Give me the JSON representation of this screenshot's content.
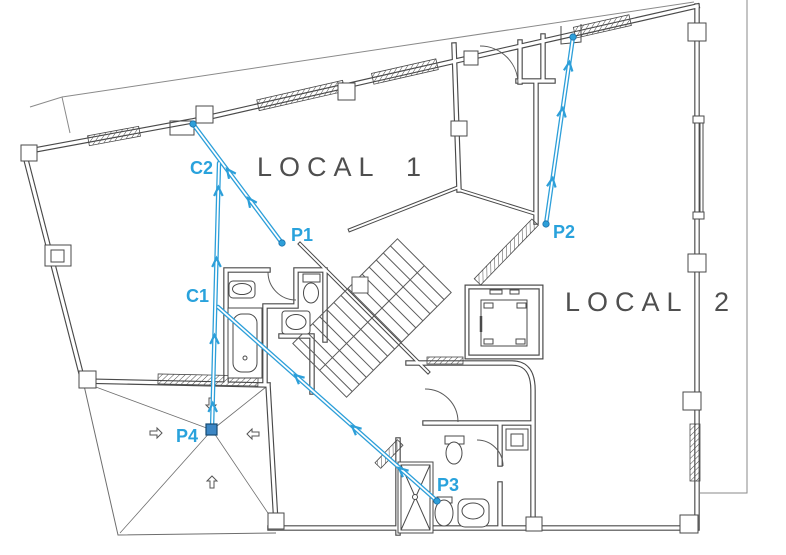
{
  "plan": {
    "room_labels": [
      {
        "id": "local-1",
        "label": "LOCAL 1"
      },
      {
        "id": "local-2",
        "label": "LOCAL 2"
      }
    ],
    "cable_labels": {
      "c1": "C1",
      "c2": "C2",
      "p1": "P1",
      "p2": "P2",
      "p3": "P3",
      "p4": "P4"
    },
    "colors": {
      "cable_blue": "#2d9fd9",
      "label_blue": "#29a2dc",
      "wall_gray": "#4a4a4a",
      "lot_gray": "#8a8a8a",
      "room_label_gray": "#4f4f4f",
      "p4_marker_fill": "#3c86c4"
    }
  }
}
